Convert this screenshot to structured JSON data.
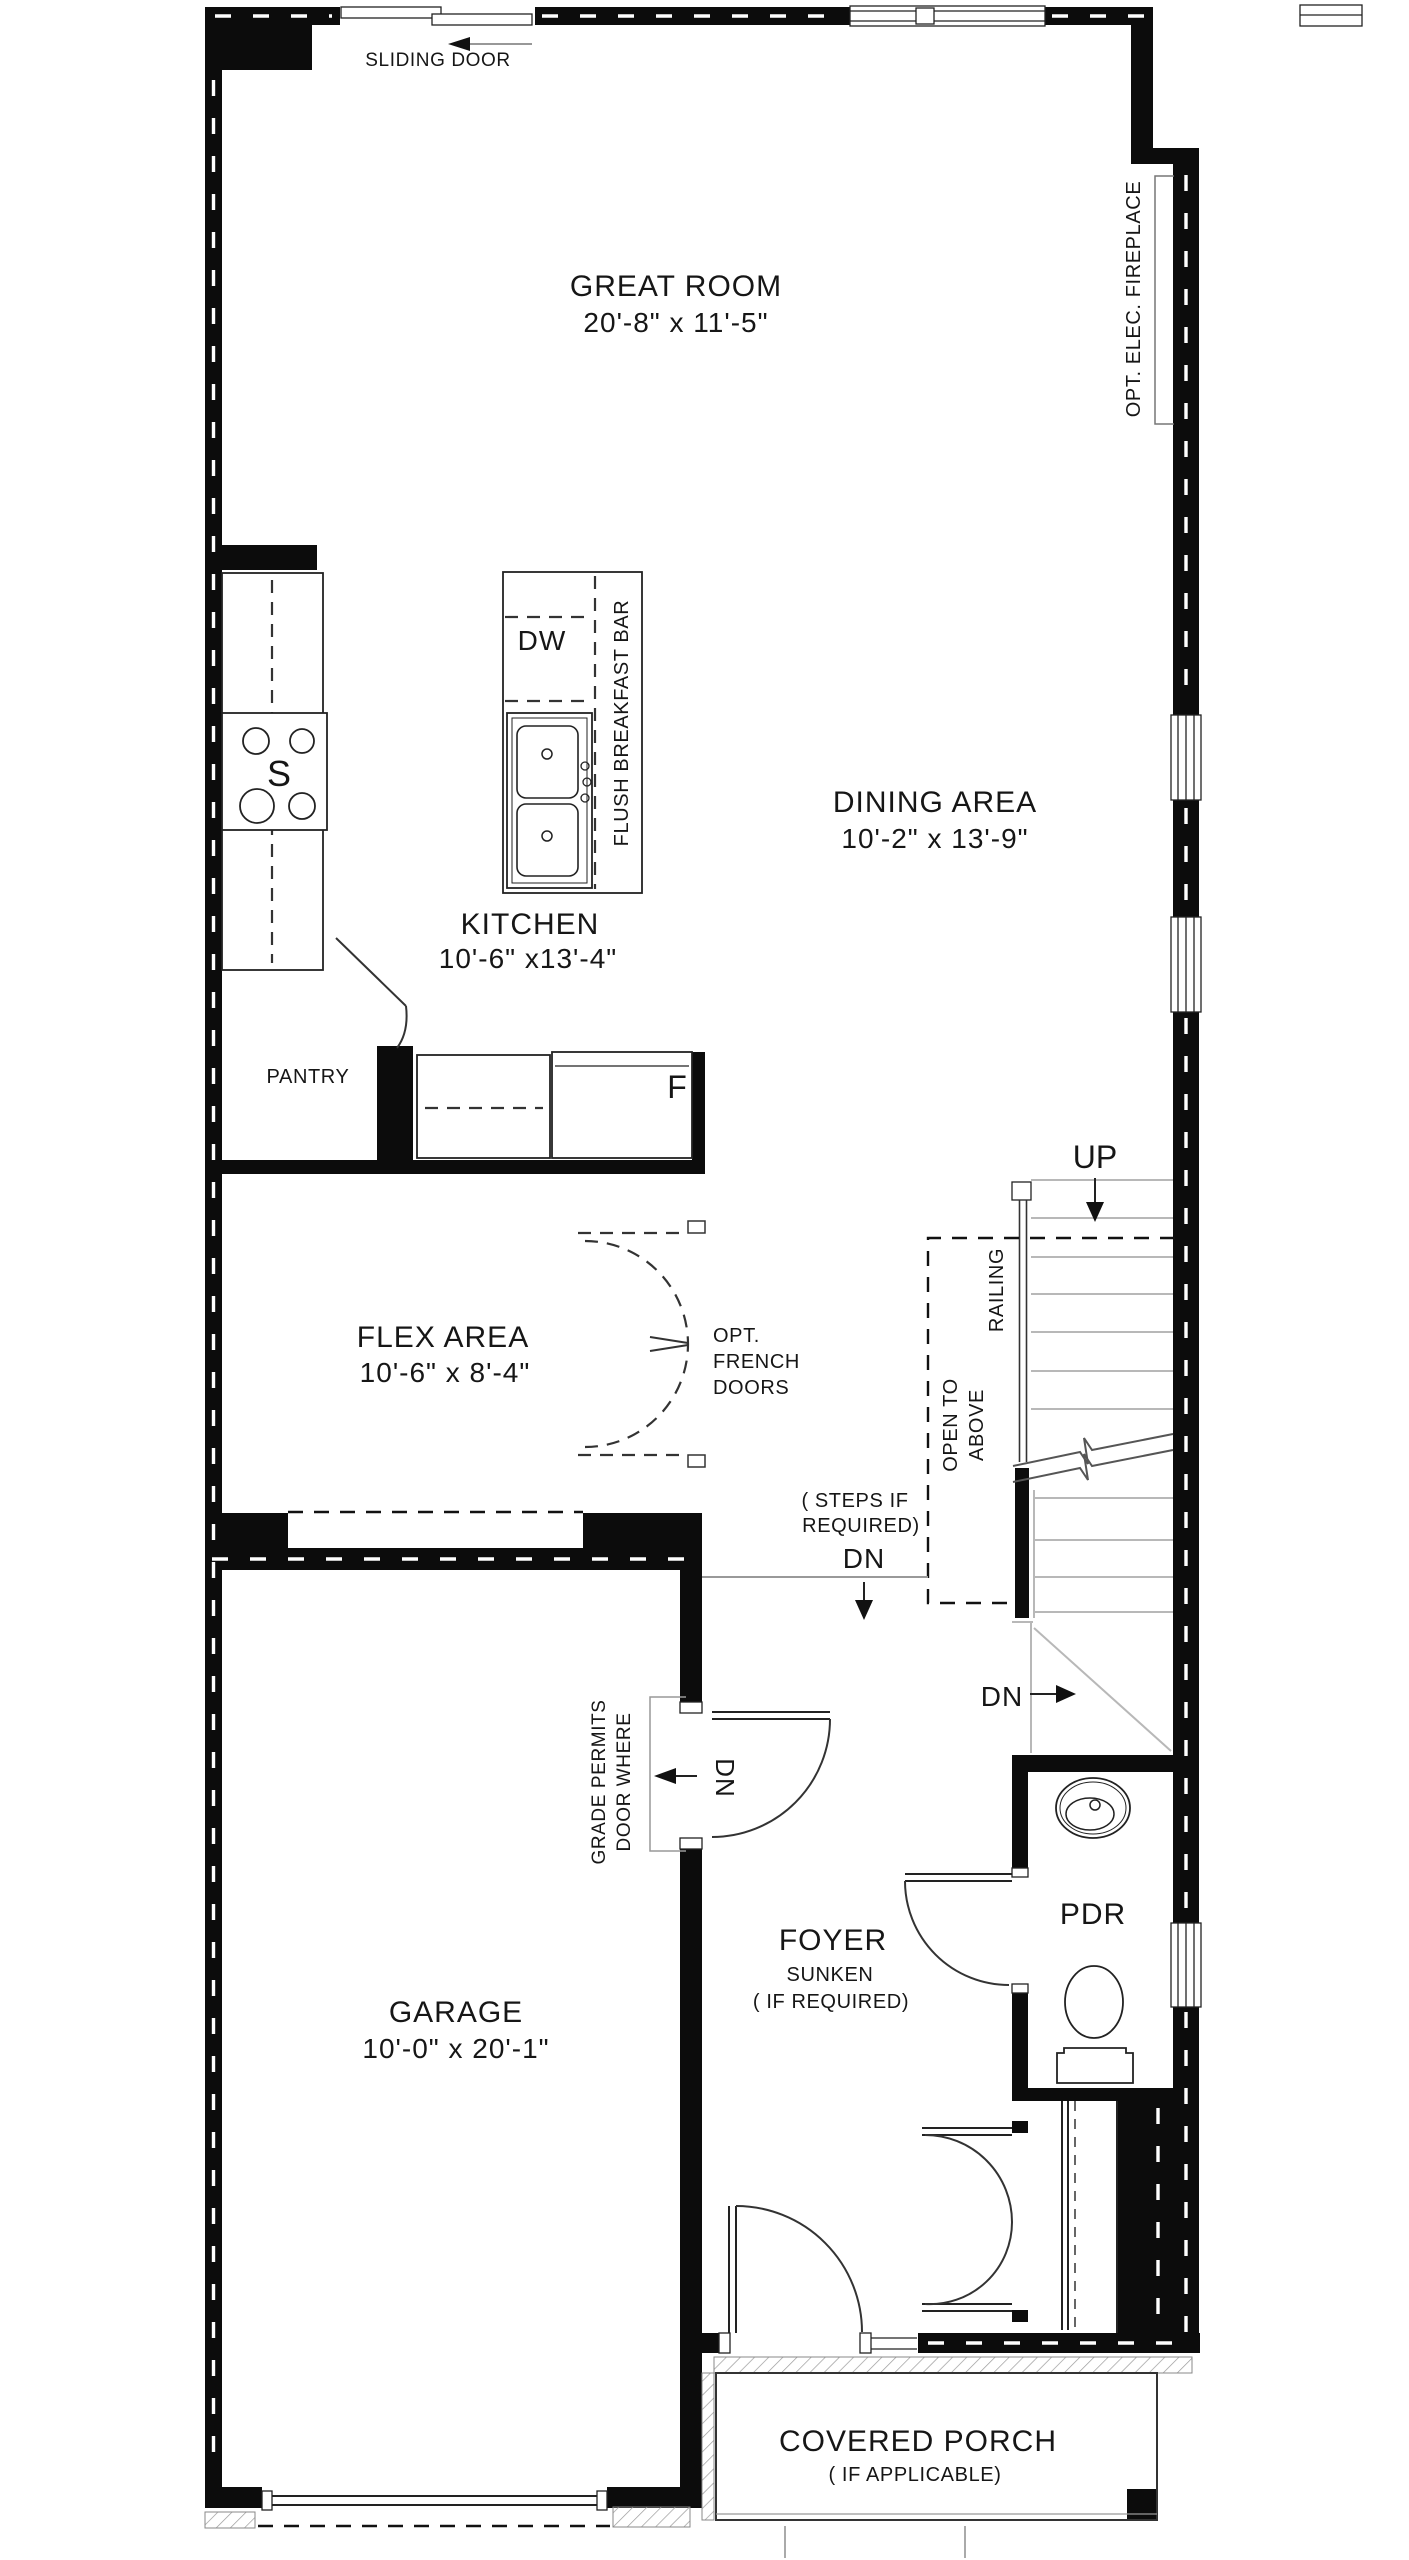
{
  "plan_type": "floor-plan",
  "colors": {
    "wall": "#0c0c0c",
    "line": "#222222",
    "light_line": "#b8b8b8",
    "background": "#ffffff"
  },
  "labels": {
    "sliding_door": "SLIDING DOOR",
    "great_room_name": "GREAT ROOM",
    "great_room_dims": "20'-8\" x 11'-5\"",
    "opt_elec_fireplace": "OPT. ELEC. FIREPLACE",
    "dishwasher": "DW",
    "stove": "S",
    "flush_breakfast_bar": "FLUSH BREAKFAST BAR",
    "dining_name": "DINING AREA",
    "dining_dims": "10'-2\" x 13'-9\"",
    "kitchen_name": "KITCHEN",
    "kitchen_dims": "10'-6\" x13'-4\"",
    "pantry": "PANTRY",
    "fridge": "F",
    "up": "UP",
    "railing": "RAILING",
    "flex_name": "FLEX AREA",
    "flex_dims": "10'-6\" x  8'-4\"",
    "opt_french_1": "OPT.",
    "opt_french_2": "FRENCH",
    "opt_french_3": "DOORS",
    "open_to_above_1": "OPEN TO",
    "open_to_above_2": "ABOVE",
    "steps_1": "( STEPS IF",
    "steps_2": "REQUIRED)",
    "dn_steps": "DN",
    "dn_stairs": "DN",
    "door_where_1": "DOOR WHERE",
    "door_where_2": "GRADE PERMITS",
    "dn_garage": "DN",
    "foyer_name": "FOYER",
    "foyer_sub1": "SUNKEN",
    "foyer_sub2": "( IF REQUIRED)",
    "pdr": "PDR",
    "garage_name": "GARAGE",
    "garage_dims": "10'-0\" x 20'-1\"",
    "porch_name": "COVERED PORCH",
    "porch_sub": "( IF APPLICABLE)"
  }
}
